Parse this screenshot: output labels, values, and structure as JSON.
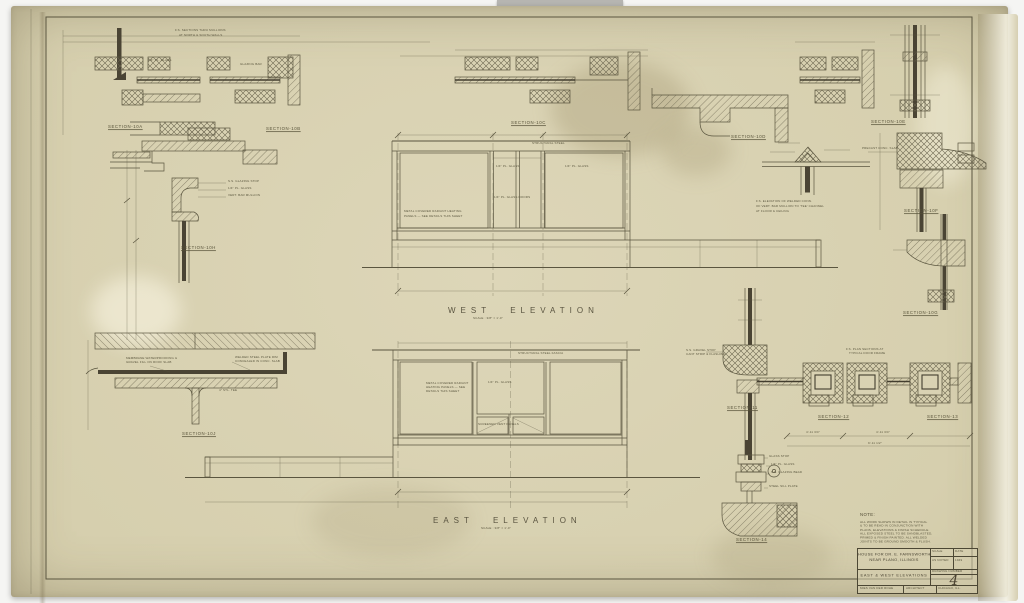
{
  "colors": {
    "paper": "#d8d1b2",
    "ink": "#5a553f",
    "ink_dark": "#433d2d",
    "text": "#57513a"
  },
  "elevations": {
    "west": {
      "title": "WEST ELEVATION",
      "scale": "SCALE : 3/8\" = 1'-0\""
    },
    "east": {
      "title": "EAST ELEVATION",
      "scale": "SCALE : 3/8\" = 1'-0\""
    }
  },
  "section_labels": [
    "SECTION-10A",
    "SECTION-10B",
    "SECTION-10C",
    "SECTION-10D",
    "SECTION-10E",
    "SECTION-10F",
    "SECTION-10G",
    "SECTION-10H",
    "SECTION-10J",
    "SECTION-11",
    "SECTION-12",
    "SECTION-13",
    "SECTION-14"
  ],
  "annotations": [
    "F.S. SECTIONS THRU MULLIONS",
    "AT NORTH & SOUTH WALLS",
    "1/4\" PL. GLASS",
    "GLAZING BAR",
    "STRUCTURAL STEEL",
    "1/4\" PL. GLASS",
    "1/4\" PL. GLASS",
    "METAL COVERED RADIANT HEATING",
    "PANELS — SEE DETAILS THIS SHEET",
    "1/4\" PL. GLASS DOORS",
    "STRUCTURAL STEEL FASCIA",
    "1/4\" PL. GLASS",
    "METAL COVERED RADIANT",
    "HEATING PANELS — SEE",
    "DETAILS THIS SHEET",
    "SCREENED VENT PANELS",
    "MEMBRANE WATERPROOFING &",
    "GRAVEL FILL ON ROOF SLAB",
    "WELDED STEEL PLATE RIM",
    "CONCEALED IN CONC. SLAB",
    "4\" STL. TEE",
    "S.S. GLAZING STOP",
    "1/4\" PL. GLASS",
    "VERT. BAR MULLION",
    "PRECAST CONC. SLAB",
    "S.S. GRAVEL STOP",
    "CANT STRIP & FLASHING",
    "GLASS STOP",
    "1/4\" PL. GLASS",
    "S.S. GLAZING BEAD",
    "STEEL SILL PLATE",
    "4'-11 3/4\"",
    "4'-11 3/4\"",
    "9'-11 1/2\"",
    "F.S. ELEVATION OF WELDED CONN.",
    "OF VERT. BAR MULLION TO 'TEE' CHANNEL",
    "AT FLOOR & CEILING",
    "F.S. PLAN SECTIONS AT",
    "TYPICAL DOOR FRAME"
  ],
  "note": {
    "title": "NOTE:",
    "lines": [
      "ALL WORK SHOWN IN DETAIL IS TYPICAL",
      "& TO BE READ IN CONJUNCTION WITH",
      "PLANS, ELEVATIONS & FINISH SCHEDULE.",
      "ALL EXPOSED STEEL TO BE SANDBLASTED,",
      "PRIMED & FINISH PAINTED. ALL WELDED",
      "JOINTS TO BE GROUND SMOOTH & FLUSH."
    ]
  },
  "title_block": {
    "project_line1": "HOUSE FOR DR. E. FARNSWORTH",
    "project_line2": "NEAR PLANO, ILLINOIS",
    "sheet_title": "EAST & WEST ELEVATIONS",
    "scale_label": "SCALE",
    "scale_value": "AS NOTED",
    "date_label": "DATE",
    "date_value": "1949",
    "drawing_number_label": "DRAWING NUMBER",
    "drawing_number": "4",
    "firm": "MIES VAN DER ROHE",
    "role": "ARCHITECT",
    "city": "CHICAGO, ILL."
  }
}
